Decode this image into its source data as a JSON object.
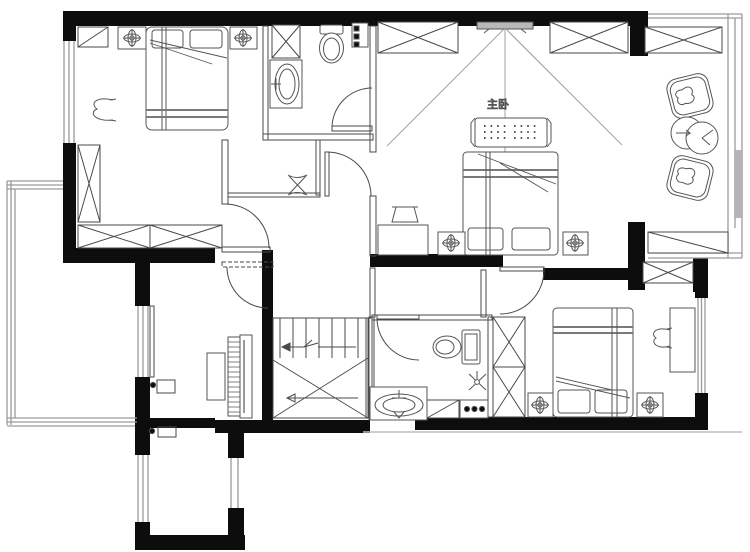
{
  "page": {
    "background": "#ffffff"
  },
  "palette": {
    "wall": "#0d0d0d",
    "line": "#4a4a4a",
    "furniture_line": "#555555",
    "window_line": "#9a9a9a",
    "gray_fill": "#bdbdbd",
    "label_color": "#9b9b9b"
  },
  "floor_plan": {
    "labels": {
      "master_bedroom": "主卧"
    },
    "icon_names": [
      "double-bed-icon",
      "pillow-icon",
      "nightstand-lamp-icon",
      "wardrobe-x-icon",
      "cabinet-diagonal-icon",
      "toilet-icon",
      "washbasin-icon",
      "shower-head-icon",
      "bed-bench-icon",
      "tv-icon",
      "sight-lines-icon",
      "dressing-table-icon",
      "stool-icon",
      "armchair-icon",
      "tea-table-icon",
      "piano-icon",
      "piano-bench-icon",
      "staircase-icon",
      "stair-arrow-icon",
      "door-arc-icon",
      "window-icon",
      "terrace-railing-icon",
      "desk-icon",
      "chair-icon",
      "shelf-dots-icon",
      "door-hinge-dot-icon"
    ]
  }
}
